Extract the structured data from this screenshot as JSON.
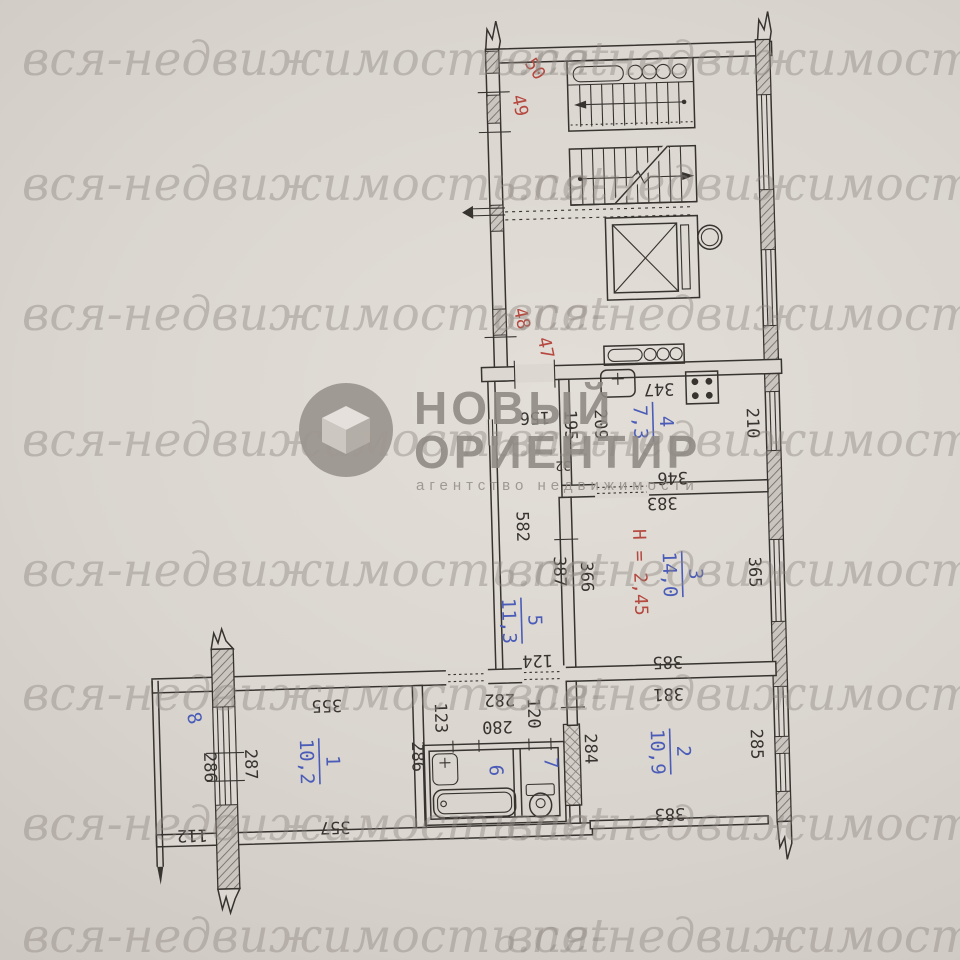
{
  "photo": {
    "watermark_text": "вся-недвижимость.net"
  },
  "logo": {
    "title_line1": "НОВЫЙ",
    "title_line2": "ОРИЕНТИР",
    "subtitle": "агентство недвижимости"
  },
  "colors": {
    "paper": "#dcd7d1",
    "ink": "#37332f",
    "red": "#b5483f",
    "blue": "#4a5cb8",
    "watermark": "#8f8882",
    "logo": "#8f8983"
  },
  "rooms": {
    "r1": {
      "num": "1",
      "area": "10,2"
    },
    "r2": {
      "num": "2",
      "area": "10,9"
    },
    "r3": {
      "num": "3",
      "area": "14,0"
    },
    "r4": {
      "num": "4",
      "area": "7,3"
    },
    "r5": {
      "num": "5",
      "area": "11,3"
    },
    "r6": {
      "num": "6"
    },
    "r7": {
      "num": "7"
    },
    "r8": {
      "num": "8"
    }
  },
  "marks": {
    "m50": "50",
    "m49": "49",
    "m48": "48",
    "m47": "47",
    "height": "Н = 2,45"
  },
  "dims": {
    "d347": "347",
    "d346": "346",
    "d210": "210",
    "d209": "209",
    "d195": "195",
    "d156": "156",
    "d32": "32",
    "d383_top": "383",
    "d385": "385",
    "d365": "365",
    "d366": "366",
    "d387": "387",
    "d582": "582",
    "d124": "124",
    "d355": "355",
    "d357": "357",
    "d282": "282",
    "d280": "280",
    "d123": "123",
    "d120": "120",
    "d286_room1": "286",
    "d284": "284",
    "d285": "285",
    "d381": "381",
    "d383_bot": "383",
    "d286_balc": "286",
    "d287": "287",
    "d112": "112"
  }
}
